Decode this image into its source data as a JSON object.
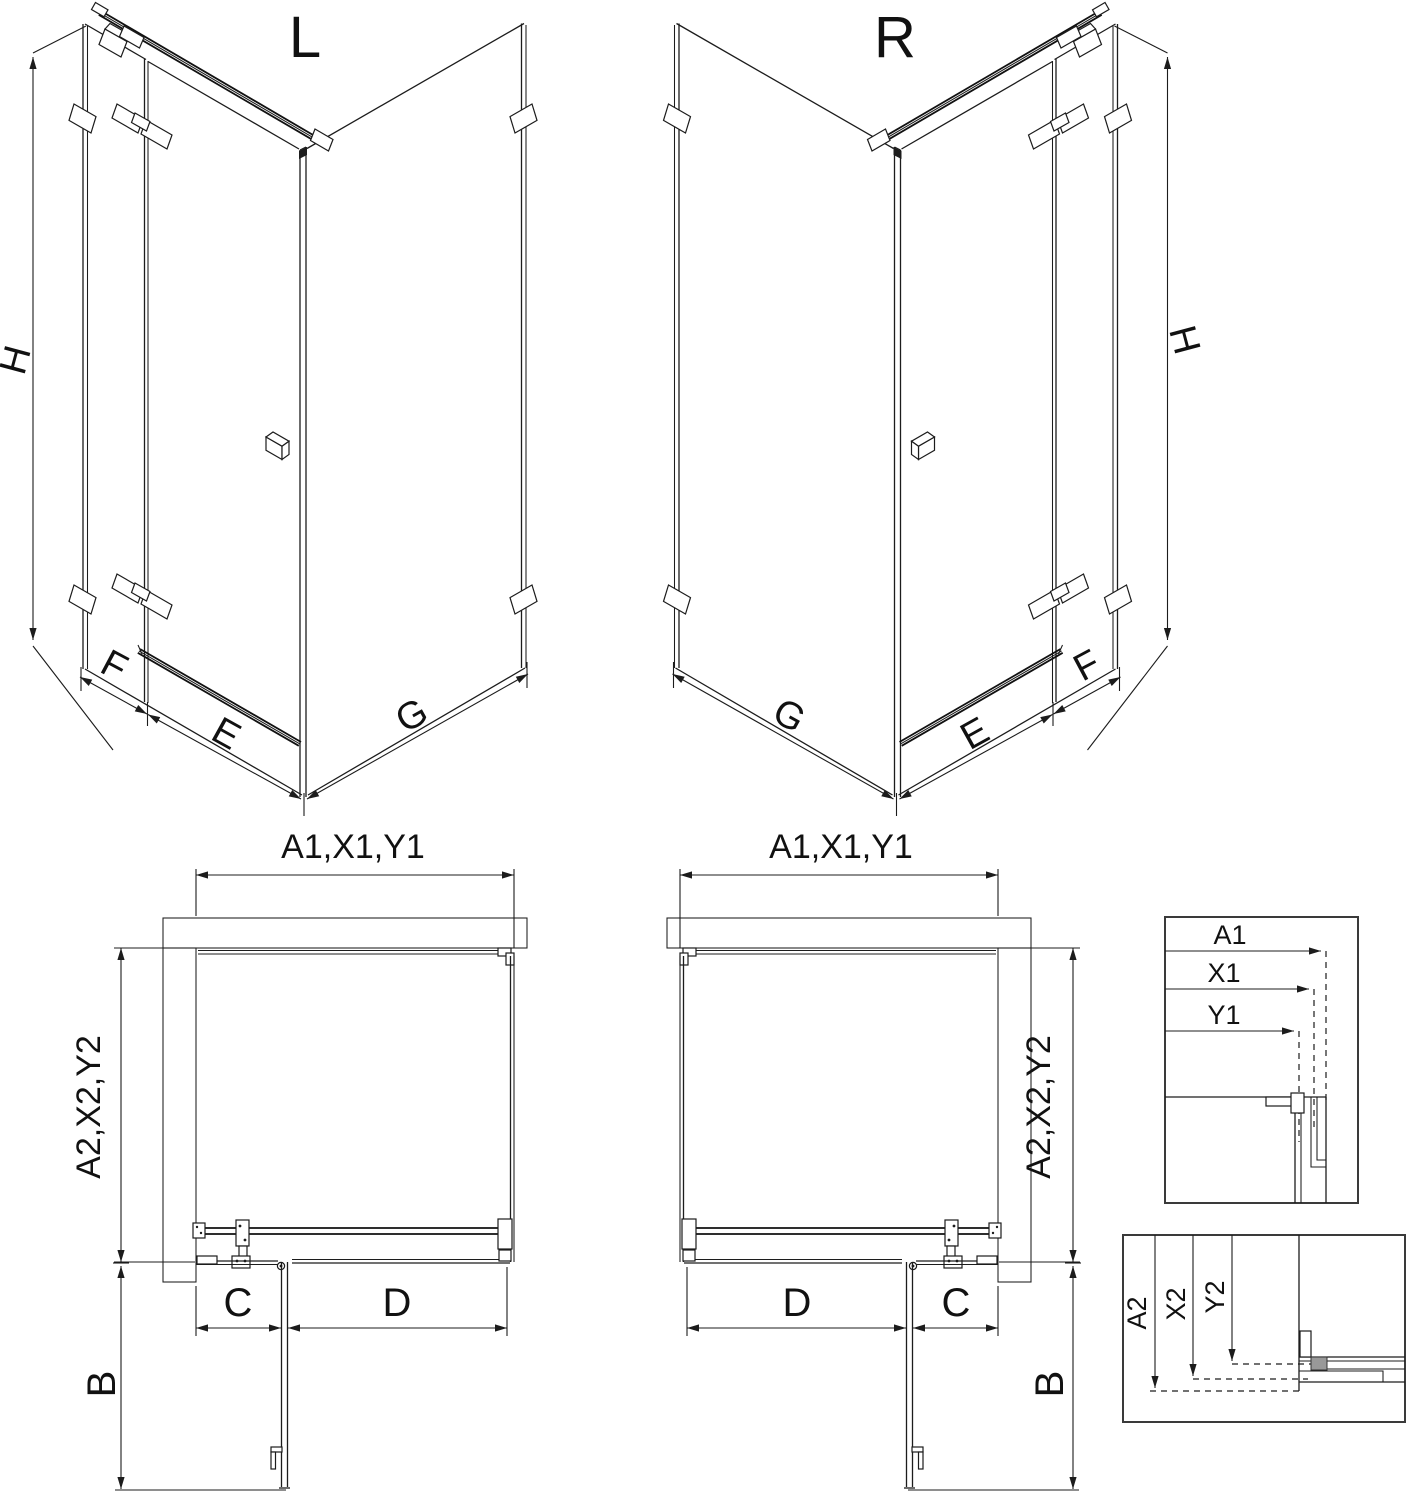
{
  "iso_views": {
    "left": {
      "variant_label": "L",
      "height_label": "H",
      "side_fixed_label": "F",
      "door_label": "E",
      "return_panel_label": "G"
    },
    "right": {
      "variant_label": "R",
      "height_label": "H",
      "side_fixed_label": "F",
      "door_label": "E",
      "return_panel_label": "G"
    }
  },
  "plan_views": {
    "left": {
      "width_dim_label": "A1,X1,Y1",
      "depth_dim_label": "A2,X2,Y2",
      "fixed_segment_label": "C",
      "door_segment_label": "D",
      "door_swing_label": "B"
    },
    "right": {
      "width_dim_label": "A1,X1,Y1",
      "depth_dim_label": "A2,X2,Y2",
      "fixed_segment_label": "C",
      "door_segment_label": "D",
      "door_swing_label": "B"
    }
  },
  "detail_panels": {
    "width_adjustment": {
      "labels": [
        "A1",
        "X1",
        "Y1"
      ]
    },
    "depth_adjustment": {
      "labels": [
        "A2",
        "X2",
        "Y2"
      ]
    }
  },
  "colors": {
    "line": "#1c1c1c",
    "background": "#ffffff",
    "hatch": "#444444",
    "profile_fill": "#999999"
  }
}
